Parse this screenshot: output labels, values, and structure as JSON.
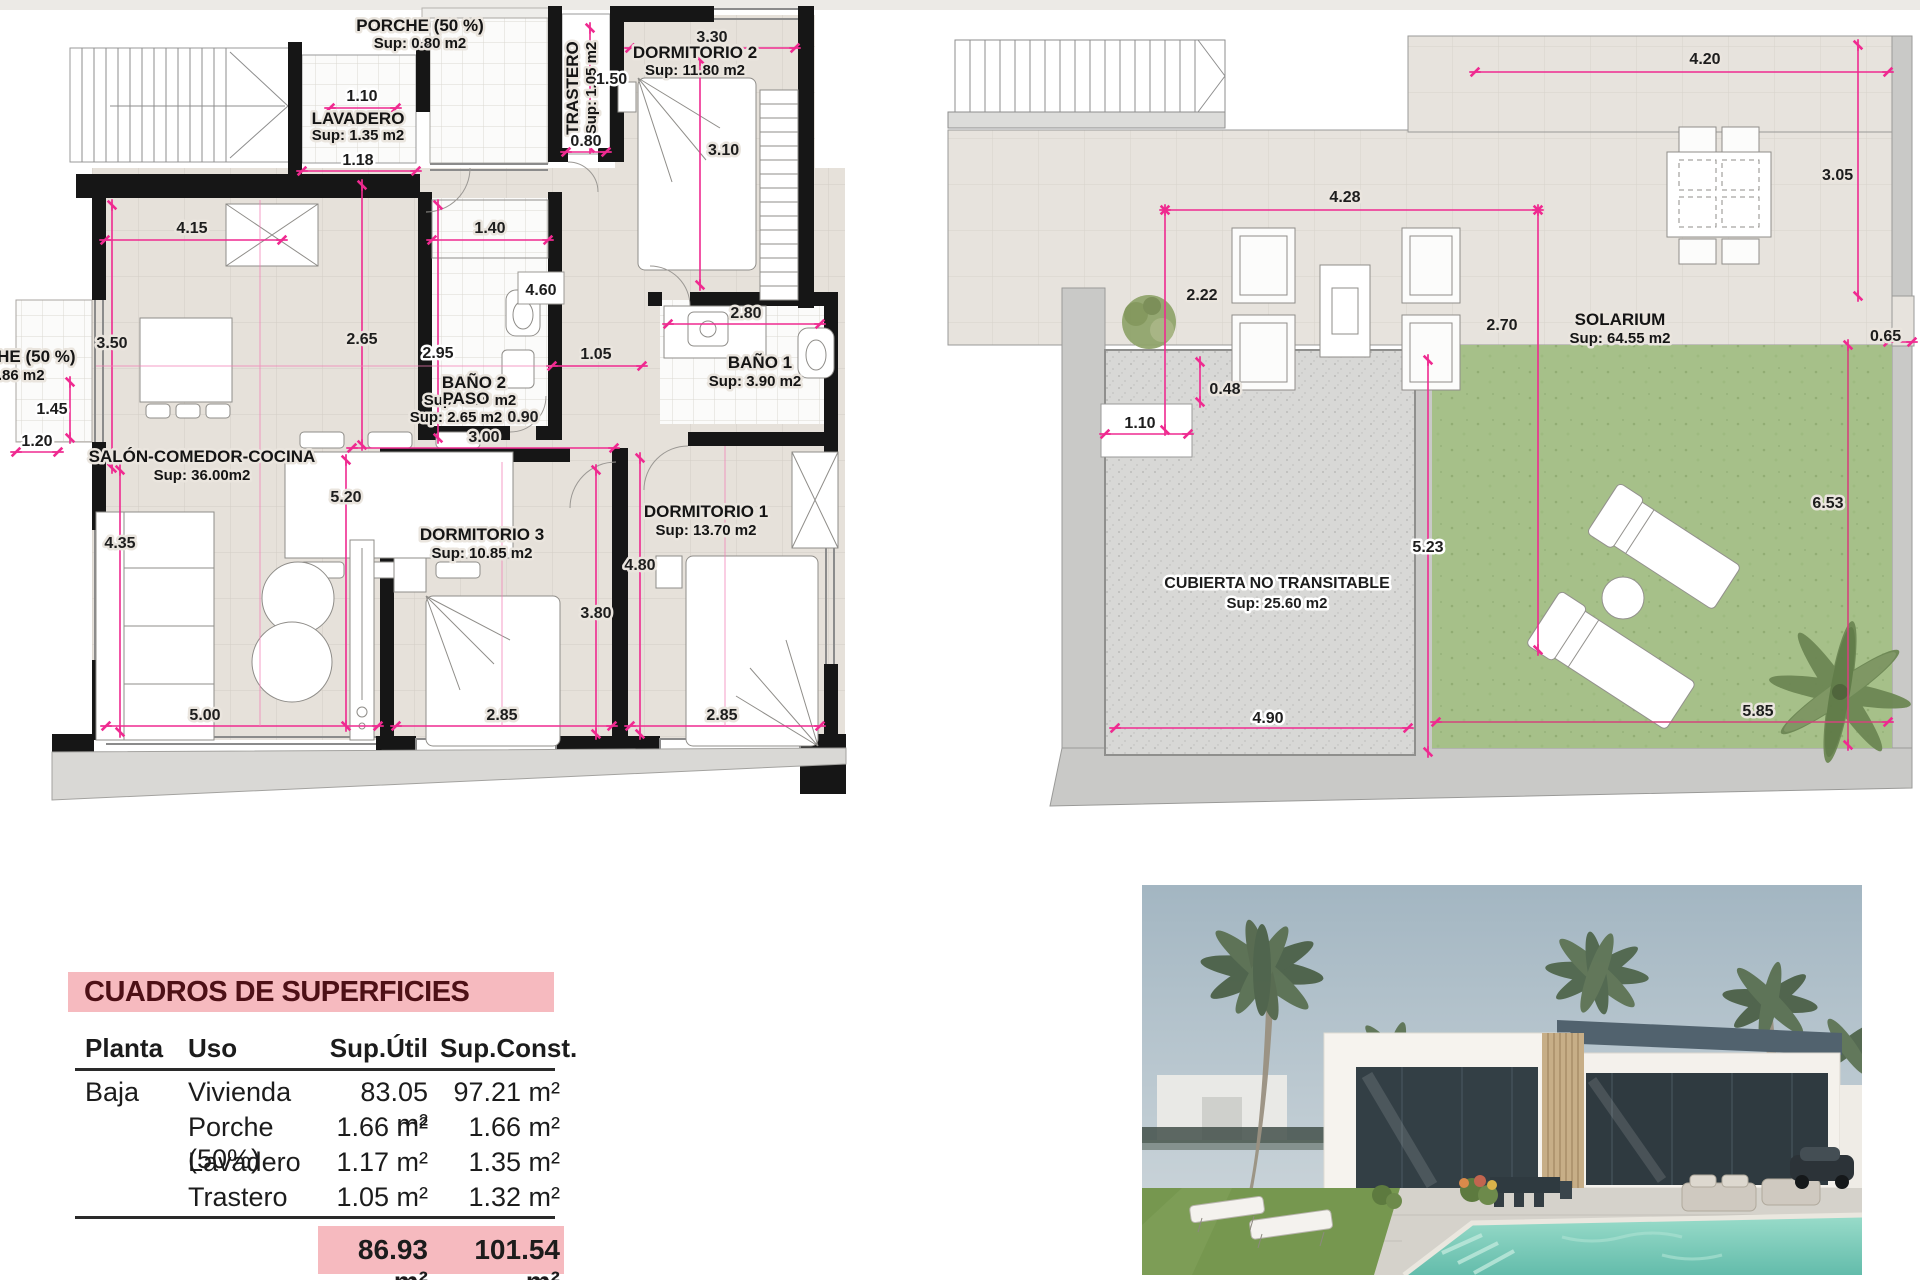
{
  "colors": {
    "dim_pink": "#ef2a90",
    "wall_black": "#161616",
    "floor_beige": "#e6e1da",
    "walkway_gray": "#c9c9c7",
    "lawn_green": "#a6c089",
    "table_pink": "#f6babf",
    "title_maroon": "#4d1016",
    "pool_teal": "#7ecfc0"
  },
  "ground_floor_plan": {
    "rooms": {
      "porche_top": {
        "name": "PORCHE (50 %)",
        "sup": "Sup: 0.80 m2"
      },
      "lavadero": {
        "name": "LAVADERO",
        "sup": "Sup: 1.35 m2"
      },
      "trastero": {
        "name": "TRASTERO",
        "sup": "Sup: 1.05 m2"
      },
      "dormitorio2": {
        "name": "DORMITORIO 2",
        "sup": "Sup: 11.80 m2"
      },
      "porche_left": {
        "name": "PORCHE (50 %)",
        "sup": "Sup: 0.86 m2"
      },
      "salon": {
        "name": "SALÓN-COMEDOR-COCINA",
        "sup": "Sup: 36.00m2"
      },
      "bano2": {
        "name": "BAÑO 2",
        "sup": "Sup: 4.15 m2"
      },
      "bano1": {
        "name": "BAÑO 1",
        "sup": "Sup: 3.90 m2"
      },
      "paso": {
        "name": "PASO",
        "sup": "Sup: 2.65 m2"
      },
      "dormitorio3": {
        "name": "DORMITORIO 3",
        "sup": "Sup: 10.85 m2"
      },
      "dormitorio1": {
        "name": "DORMITORIO 1",
        "sup": "Sup: 13.70 m2"
      }
    },
    "dims": {
      "lav_top": "1.10",
      "lav_bottom": "1.18",
      "tras_h": "1.50",
      "tras_w": "0.80",
      "dorm2_w": "3.30",
      "dorm2_h": "3.10",
      "kitchen_w": "4.15",
      "bano2_top": "1.40",
      "dorm2_wall": "4.60",
      "salon_mid_h": "2.65",
      "bano2_h": "2.95",
      "salon_top_left": "3.50",
      "porche_left_h": "1.45",
      "porche_left_w": "1.20",
      "paso_door": "1.05",
      "bano1_w": "2.80",
      "paso_side": "0.90",
      "paso_w": "3.00",
      "salon_len": "5.20",
      "salon_left": "4.35",
      "dorm1_h": "4.80",
      "dorm3_h": "3.80",
      "bottom_salon": "5.00",
      "bottom_dorm3": "2.85",
      "bottom_dorm1": "2.85"
    }
  },
  "roof_plan": {
    "rooms": {
      "solarium": {
        "name": "SOLARIUM",
        "sup": "Sup: 64.55 m2"
      },
      "cubierta": {
        "name": "CUBIERTA NO TRANSITABLE",
        "sup": "Sup: 25.60 m2"
      }
    },
    "dims": {
      "top_w": "4.20",
      "right_h": "3.05",
      "inner_w": "4.28",
      "left_h": "2.22",
      "mid_h": "2.70",
      "step": "0.48",
      "porch_w": "1.10",
      "notch": "0.65",
      "cub_h": "5.23",
      "lawn_h": "6.53",
      "cub_w": "4.90",
      "lawn_w": "5.85"
    }
  },
  "areas_table": {
    "title": "CUADROS DE SUPERFICIES",
    "headers": {
      "planta": "Planta",
      "uso": "Uso",
      "util": "Sup.Útil",
      "const": "Sup.Const."
    },
    "rows": [
      {
        "planta": "Baja",
        "uso": "Vivienda",
        "util": "83.05 m²",
        "const": "97.21 m²"
      },
      {
        "planta": "",
        "uso": "Porche (50%)",
        "util": "1.66 m²",
        "const": "1.66 m²"
      },
      {
        "planta": "",
        "uso": "Lavadero",
        "util": "1.17 m²",
        "const": "1.35 m²"
      },
      {
        "planta": "",
        "uso": "Trastero",
        "util": "1.05 m²",
        "const": "1.32 m²"
      }
    ],
    "totals": {
      "util": "86.93 m²",
      "const": "101.54 m²"
    }
  }
}
